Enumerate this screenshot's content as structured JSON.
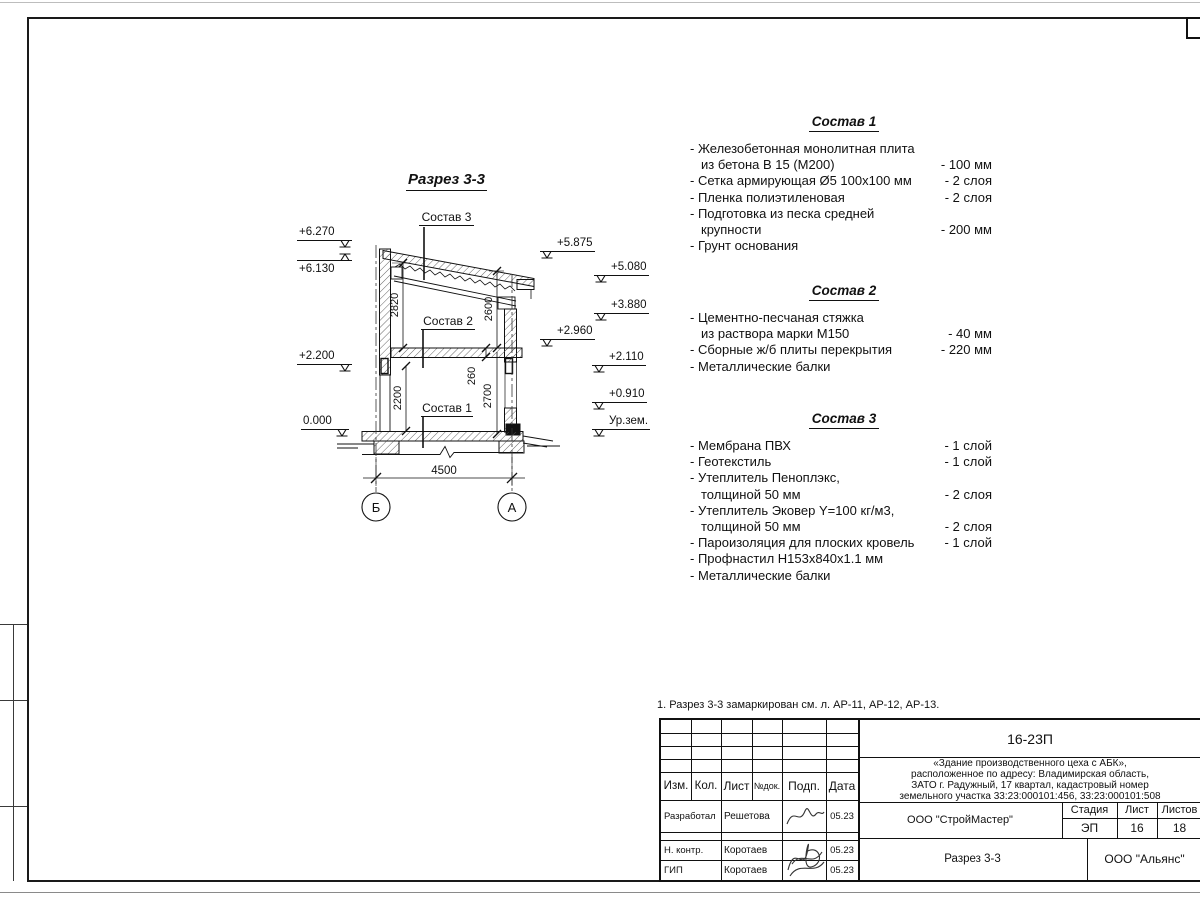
{
  "page": {
    "note": "1. Разрез 3-3 замаркирован см. л. АР-11, АР-12, АР-13."
  },
  "drawing": {
    "title": "Разрез 3-3",
    "callouts": [
      "Состав 3",
      "Состав 2",
      "Состав 1"
    ],
    "elevations": {
      "left": [
        "+6.270",
        "+6.130",
        "+2.200",
        "0.000"
      ],
      "near_right": [
        "+5.875",
        "+2.960"
      ],
      "far_right": [
        "+5.080",
        "+3.880",
        "+2.110",
        "+0.910",
        "Ур.зем."
      ]
    },
    "dimensions": {
      "upper_left": "2820",
      "upper_right": "2600",
      "lower_left": "2200",
      "slab": "260",
      "lower_right": "2700",
      "width": "4500"
    },
    "axes": {
      "left": "Б",
      "right": "А"
    }
  },
  "lists": [
    {
      "title": "Состав 1",
      "rows": [
        {
          "t": "- Железобетонная  монолитная плита",
          "v": ""
        },
        {
          "t": "из бетона В 15 (М200)",
          "v": "- 100 мм",
          "indent": true
        },
        {
          "t": "- Сетка армирующая Ø5 100x100 мм",
          "v": "- 2 слоя"
        },
        {
          "t": "- Пленка полиэтиленовая",
          "v": "- 2 слоя"
        },
        {
          "t": "- Подготовка из песка средней",
          "v": ""
        },
        {
          "t": "крупности",
          "v": "- 200 мм",
          "indent": true
        },
        {
          "t": "- Грунт основания",
          "v": ""
        }
      ]
    },
    {
      "title": "Состав 2",
      "rows": [
        {
          "t": "- Цементно-песчаная стяжка",
          "v": ""
        },
        {
          "t": "из раствора марки М150",
          "v": "- 40 мм",
          "indent": true
        },
        {
          "t": "- Сборные ж/б плиты перекрытия",
          "v": "- 220 мм"
        },
        {
          "t": "- Металлические балки",
          "v": ""
        }
      ]
    },
    {
      "title": "Состав 3",
      "rows": [
        {
          "t": "- Мембрана ПВХ",
          "v": "- 1 слой"
        },
        {
          "t": "- Геотекстиль",
          "v": "- 1 слой"
        },
        {
          "t": "- Утеплитель Пеноплэкс,",
          "v": ""
        },
        {
          "t": "толщиной 50 мм",
          "v": "- 2 слоя",
          "indent": true
        },
        {
          "t": "- Утеплитель Эковер Y=100 кг/м3,",
          "v": ""
        },
        {
          "t": "толщиной 50 мм",
          "v": "- 2 слоя",
          "indent": true
        },
        {
          "t": "- Пароизоляция для плоских кровель",
          "v": "- 1 слой"
        },
        {
          "t": "- Профнастил Н153х840х1.1 мм",
          "v": ""
        },
        {
          "t": "- Металлические балки",
          "v": ""
        }
      ]
    }
  ],
  "titleblock": {
    "doc_number": "16-23П",
    "object_desc": {
      "line1": "«Здание производственного цеха с АБК»,",
      "line2": "расположенное по адресу: Владимирская область,",
      "line3": "ЗАТО г. Радужный, 17 квартал, кадастровый номер",
      "line4": "земельного участка 33:23:000101:456, 33:23:000101:508"
    },
    "header": {
      "izm": "Изм.",
      "kol": "Кол.",
      "list": "Лист",
      "ndok": "№док.",
      "podp": "Подп.",
      "data": "Дата"
    },
    "rows": [
      {
        "role": "Разработал",
        "name": "Решетова",
        "date": "05.23"
      },
      {
        "role": "Н. контр.",
        "name": "Коротаев",
        "date": "05.23"
      },
      {
        "role": "ГИП",
        "name": "Коротаев",
        "date": "05.23"
      }
    ],
    "contractor": "ООО \"СтройМастер\"",
    "stage_label": "Стадия",
    "sheet_label": "Лист",
    "sheets_label": "Листов",
    "stage": "ЭП",
    "sheet": "16",
    "sheets": "18",
    "sheet_title": "Разрез 3-3",
    "company": "ООО \"Альянс\""
  }
}
